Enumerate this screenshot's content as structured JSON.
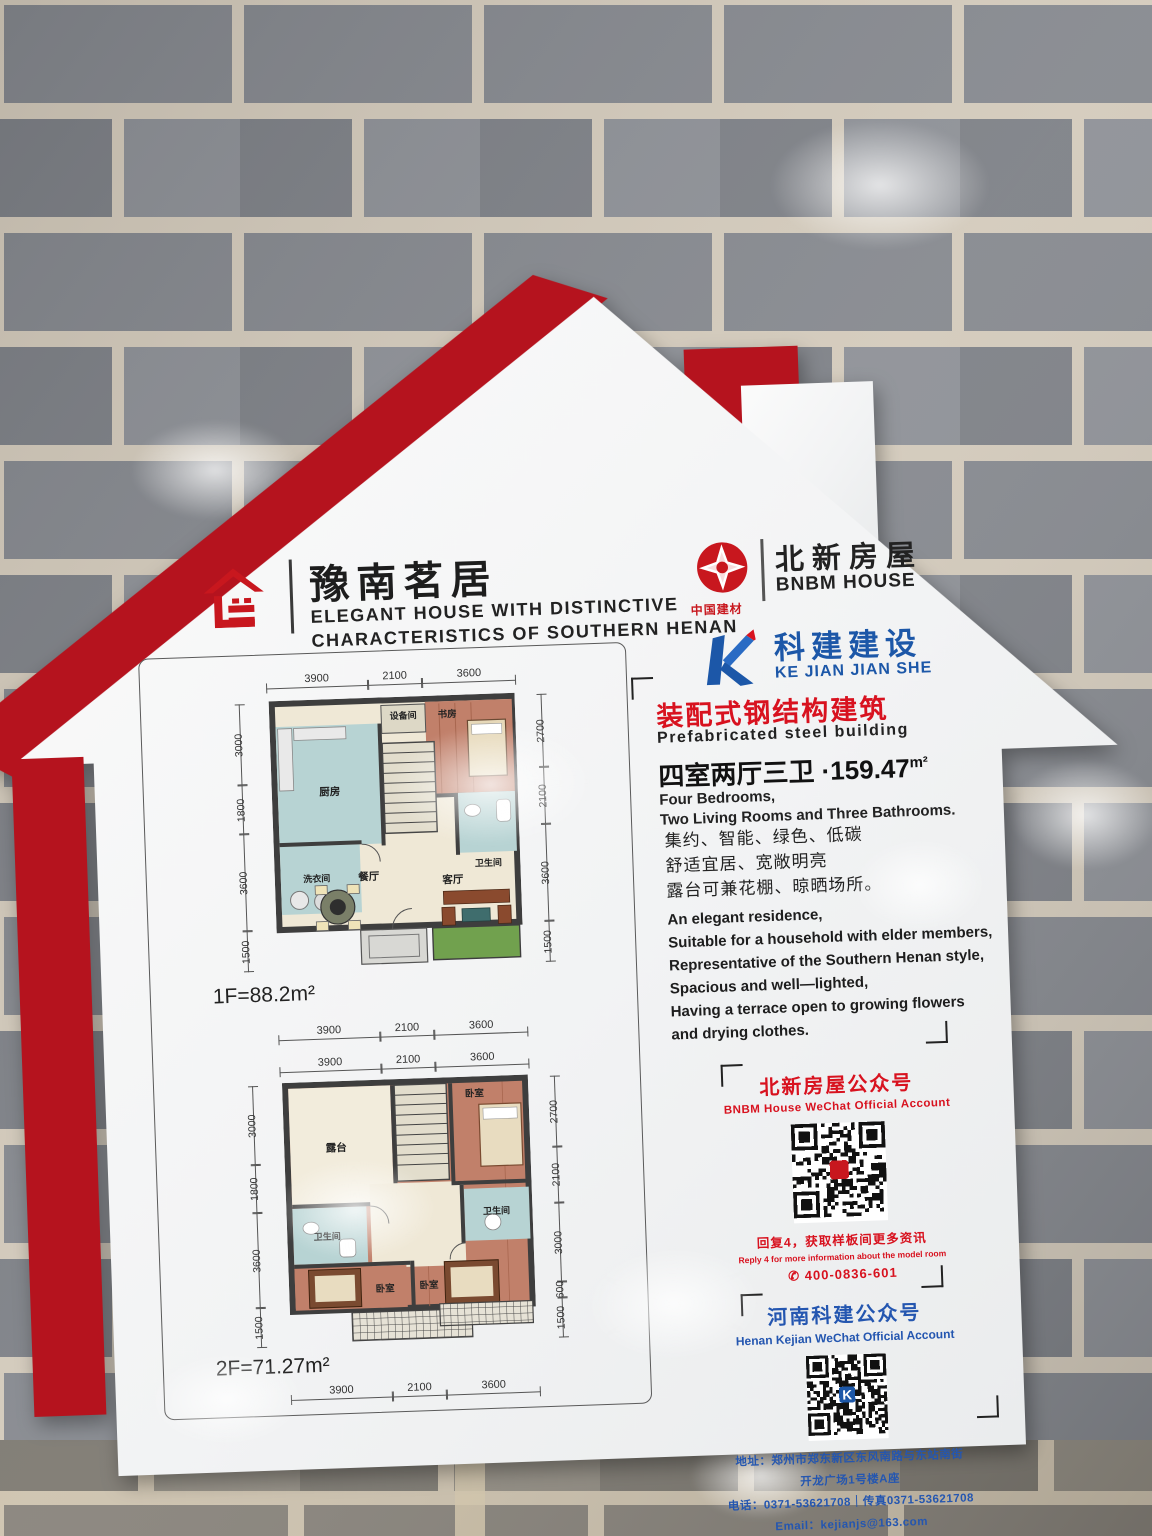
{
  "sign": {
    "header": {
      "title_cn": "豫南茗居",
      "subtitle_en_line1": "ELEGANT HOUSE WITH DISTINCTIVE",
      "subtitle_en_line2": "CHARACTERISTICS OF SOUTHERN HENAN"
    },
    "brands": {
      "cnbm_label": "中国建材",
      "bnbm_cn": "北新房屋",
      "bnbm_en": "BNBM HOUSE",
      "kejian_cn": "科建建设",
      "kejian_en": "KE JIAN JIAN SHE"
    },
    "highlight": {
      "title_cn": "装配式钢结构建筑",
      "title_en": "Prefabricated steel building",
      "spec_cn": "四室两厅三卫 ·159.47",
      "spec_unit": "m²",
      "spec_en_line1": "Four Bedrooms,",
      "spec_en_line2": "Two Living Rooms and Three Bathrooms."
    },
    "features_cn": [
      "集约、智能、绿色、低碳",
      "舒适宜居、宽敞明亮",
      "露台可兼花棚、晾晒场所。"
    ],
    "features_en": [
      "An elegant residence,",
      "Suitable for a household with elder members,",
      "Representative of the Southern Henan style,",
      "Spacious and well—lighted,",
      "Having a terrace open to growing flowers",
      "and drying clothes."
    ],
    "wechat_bnbm": {
      "title_cn": "北新房屋公众号",
      "title_en": "BNBM House WeChat Official Account",
      "tip_cn": "回复4，获取样板间更多资讯",
      "tip_en": "Reply 4 for more information about the model room",
      "phone_icon": "✆",
      "phone": "400-0836-601"
    },
    "wechat_kejian": {
      "title_cn": "河南科建公众号",
      "title_en": "Henan Kejian WeChat Official Account",
      "address_line1": "地址：郑州市郑东新区东风南路与东站南街",
      "address_line2": "开龙广场1号楼A座",
      "phone_fax": "电话：0371-53621708｜传真0371-53621708",
      "email": "Email：kejianjs@163.com"
    },
    "floorplans": {
      "f1": {
        "label": "1F=88.2m²",
        "dims_top": [
          "3900",
          "2100",
          "3600"
        ],
        "dims_bottom": [
          "3900",
          "2100",
          "3600"
        ],
        "dims_left": [
          "3000",
          "1800",
          "3600",
          "1500"
        ],
        "dims_right": [
          "2700",
          "2100",
          "3600",
          "1500"
        ],
        "rooms": {
          "kitchen": "厨房",
          "equipment": "设备间",
          "study": "书房",
          "laundry": "洗衣间",
          "bath": "卫生间",
          "dining": "餐厅",
          "living": "客厅"
        }
      },
      "f2": {
        "label": "2F=71.27m²",
        "dims_top": [
          "3900",
          "2100",
          "3600"
        ],
        "dims_bottom": [
          "3900",
          "2100",
          "3600"
        ],
        "dims_left": [
          "3000",
          "1800",
          "3600",
          "1500"
        ],
        "dims_right": [
          "2700",
          "2100",
          "3000",
          "600",
          "1500"
        ],
        "rooms": {
          "terrace": "露台",
          "bedroom_top": "卧室",
          "bath_left": "卫生间",
          "bath_right": "卫生间",
          "bedroom_bl": "卧室",
          "bedroom_br": "卧室"
        }
      }
    },
    "colors": {
      "sign_red": "#b5131e",
      "text_red": "#d8121f",
      "kejian_blue": "#1c57a8",
      "cnbm_red": "#c8171e"
    }
  }
}
